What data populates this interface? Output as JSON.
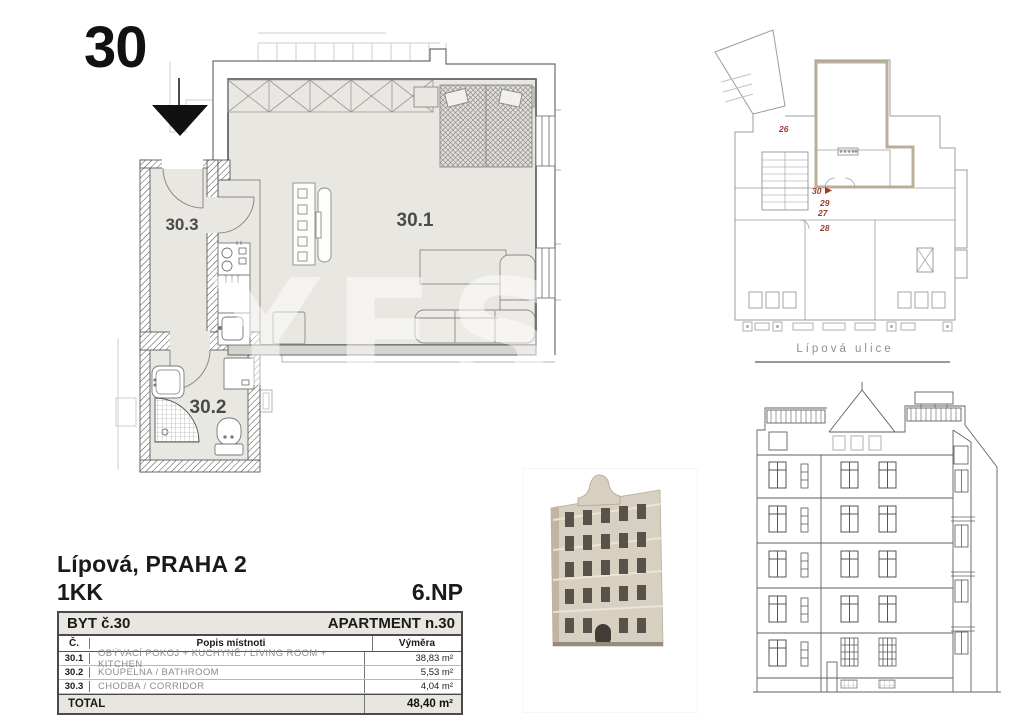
{
  "page": {
    "unit_number": "30",
    "title": "Lípová, PRAHA 2",
    "disposition": "1KK",
    "floor": "6.NP",
    "watermark": "YES"
  },
  "floor_plan": {
    "room_labels": {
      "living": "30.1",
      "bathroom": "30.2",
      "corridor": "30.3"
    }
  },
  "key_plan": {
    "street_label": "Lípová ulice",
    "unit_labels": {
      "u26": "26",
      "u30": "30",
      "u29": "29",
      "u27": "27",
      "u28": "28"
    },
    "highlight_color": "#b3a68c",
    "label_color": "#a03a30"
  },
  "table": {
    "header_left": "BYT č.30",
    "header_right": "APARTMENT n.30",
    "columns": {
      "number": "Č.",
      "description": "Popis místnoti",
      "area": "Výměra"
    },
    "rows": [
      {
        "num": "30.1",
        "desc": "OBÝVACÍ POKOJ + KUCHYNĚ / LIVING ROOM + KITCHEN",
        "area": "38,83 m²"
      },
      {
        "num": "30.2",
        "desc": "KOUPELNA / BATHROOM",
        "area": "5,53 m²"
      },
      {
        "num": "30.3",
        "desc": "CHODBA / CORRIDOR",
        "area": "4,04 m²"
      }
    ],
    "total_label": "TOTAL",
    "total_area": "48,40 m²"
  },
  "colors": {
    "floor_fill": "#e9e7e1",
    "table_header_bg": "#e9e6df",
    "wall_line": "#4a4a4a"
  }
}
